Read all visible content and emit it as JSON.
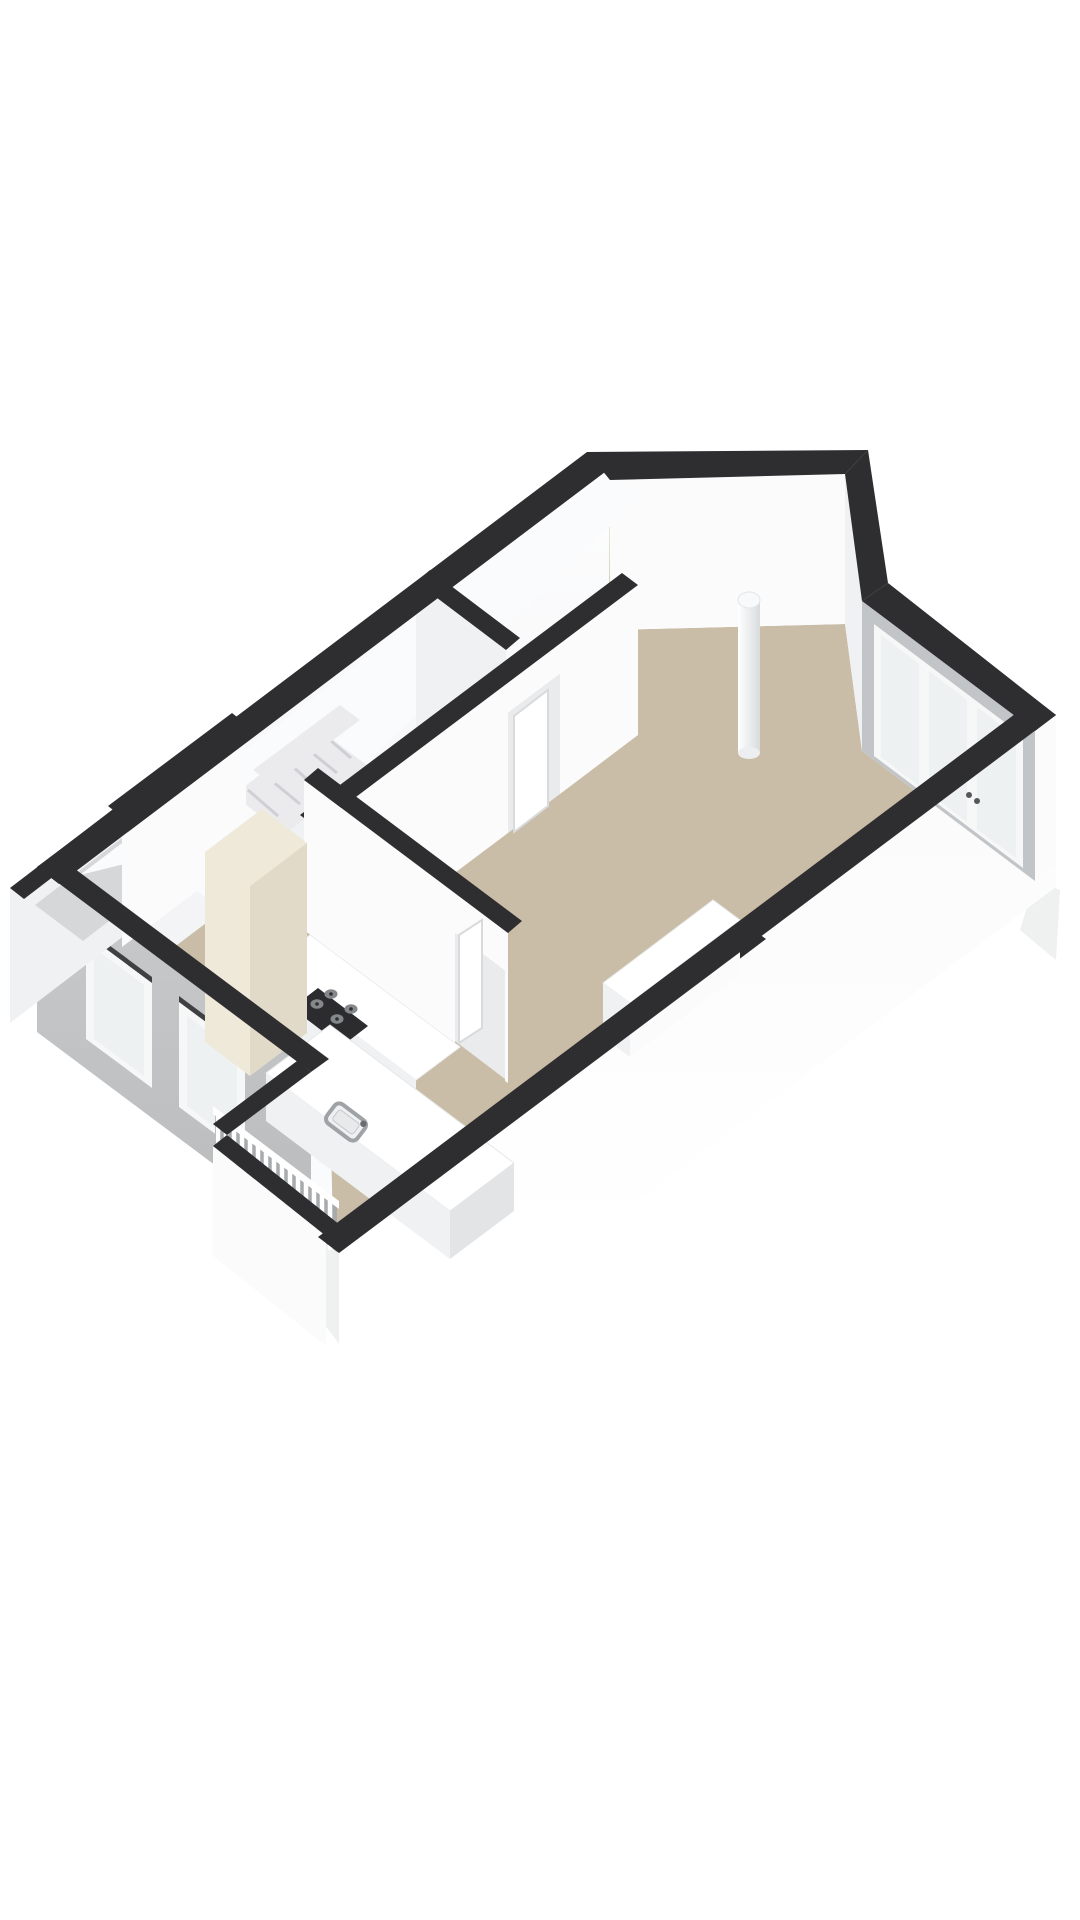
{
  "meta": {
    "type": "3d-floor-plan-render",
    "view": "axonometric",
    "visible_text": "none"
  },
  "colors": {
    "background": "#ffffff",
    "wall_top": "#2e2e30",
    "wall_face": "#fbfbfc",
    "wall_face_shaded": "#eff1f3",
    "wall_face_dark": "#e2e4e6",
    "floor_main": "#c9bda7",
    "floor_light": "#fafbfc",
    "floor_gray": "#d5d7d9",
    "facade_gray": "#c5c7c9",
    "glass": "#eef1f2",
    "frame_white": "#f6f7f7",
    "cabinet_cream": "#efe9da",
    "cabinet_cream_dark": "#e2dac8",
    "cooktop_black": "#2c2c2e",
    "burner_gray": "#85888b",
    "marble_base": "#ebebed",
    "marble_streak": "#c8c8cd",
    "railing_void": "#a7abae",
    "shadow_soft": "#eff0f0",
    "sink_steel": "#9fa3a6",
    "handle_dark": "#55585a",
    "column_light": "#ffffff",
    "column_shade": "#d8dbdd"
  },
  "elements": [
    "nw-exterior-wall",
    "cut-corner-wall",
    "ne-corner-wall",
    "window-wall-french-doors",
    "se-exterior-wall",
    "sw-facade-with-windows",
    "porch-walls",
    "balcony-railing",
    "living-room-floor",
    "kitchen-floor",
    "interior-partition-walls",
    "staircase-marble",
    "hallway-door",
    "kitchen-door",
    "kitchen-wall-counter",
    "gas-cooktop",
    "tall-cabinet",
    "kitchen-island",
    "island-sink",
    "sink-faucet",
    "window-sill-box",
    "structural-column",
    "facade-window-1",
    "facade-window-2"
  ]
}
